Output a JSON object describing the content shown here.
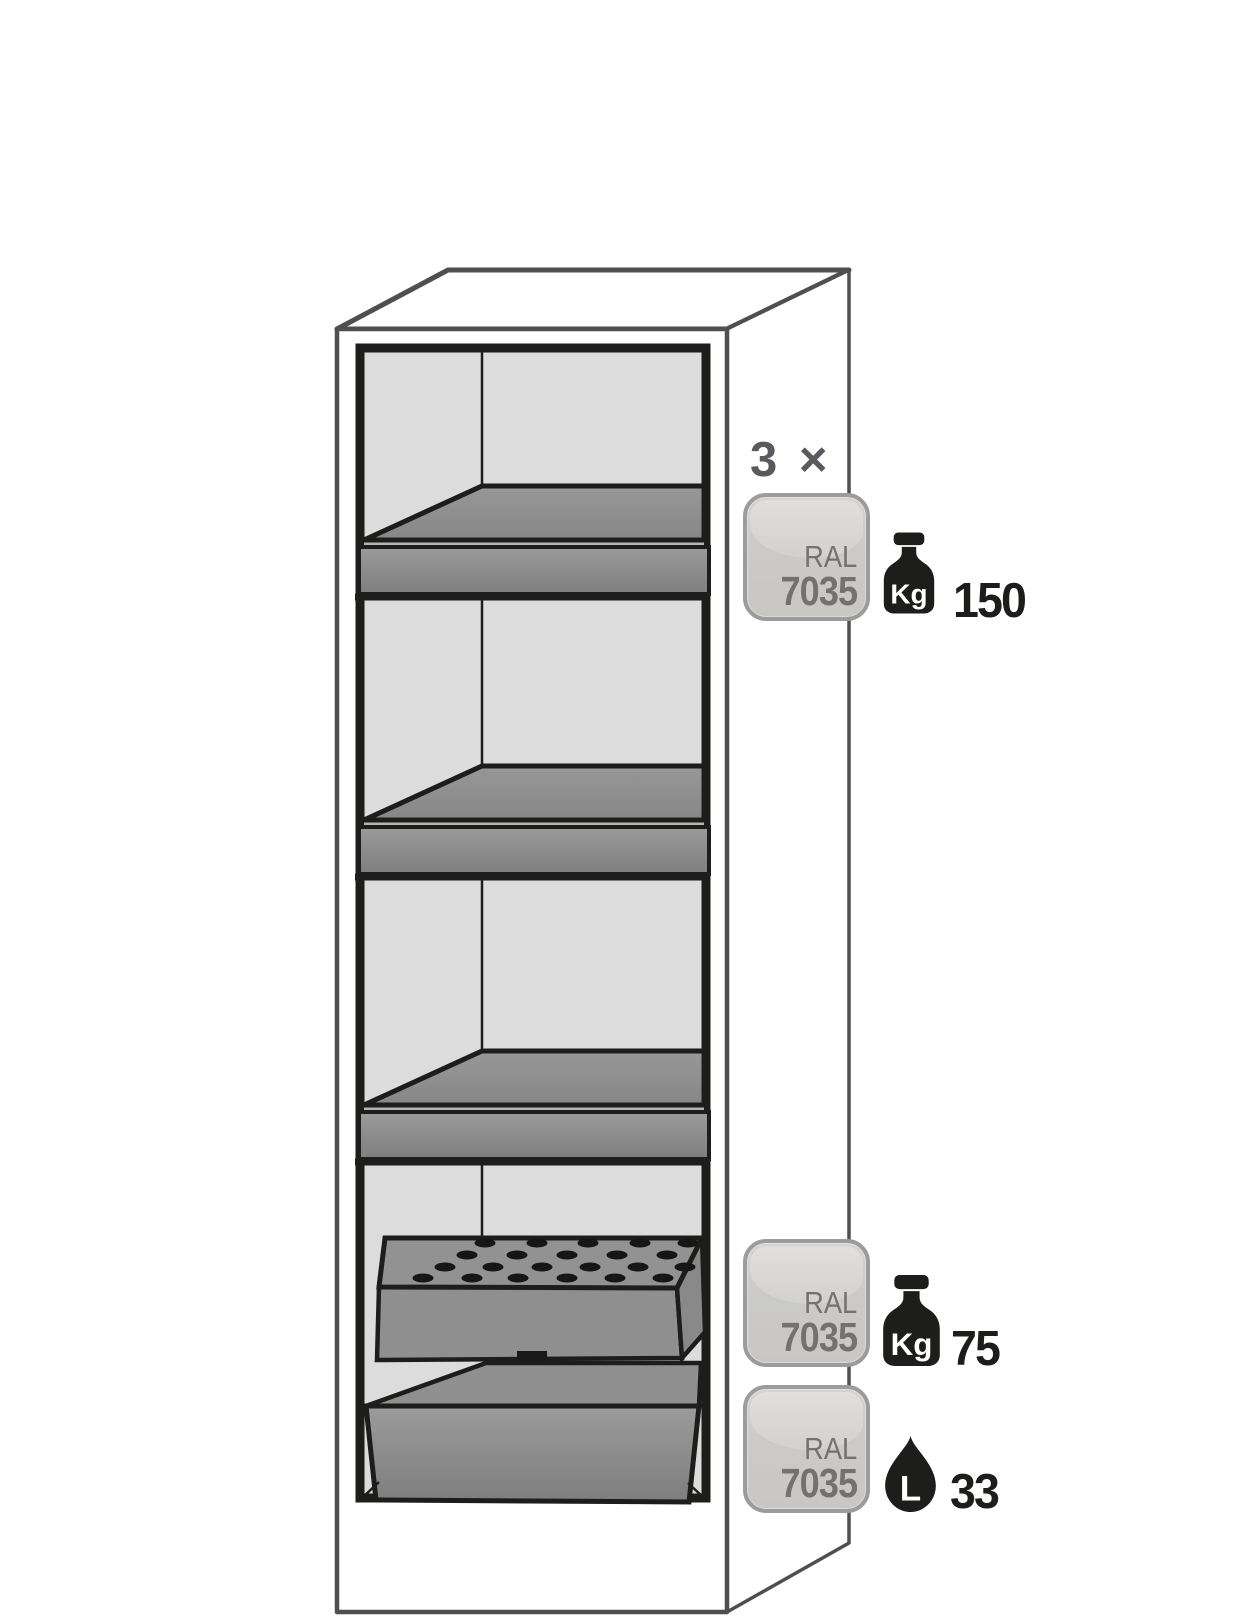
{
  "diagram": {
    "subject": "safety cabinet interior with shelves, perforated insert and sump tray",
    "colors": {
      "interior_grey": "#dcdcdc",
      "tray_grey": "#8f8f8f",
      "outline_black": "#1d1d1b",
      "cabinet_line_grey": "#4f4f4f",
      "badge_border_grey": "#9c9c9c",
      "badge_text_grey": "#74726e",
      "count_label_grey": "#5a5a5e"
    },
    "annotations": {
      "shelves": {
        "count_label": "3 ×",
        "ral_line1": "RAL",
        "ral_line2": "7035",
        "unit": "Kg",
        "value": "150"
      },
      "insert": {
        "ral_line1": "RAL",
        "ral_line2": "7035",
        "unit": "Kg",
        "value": "75"
      },
      "sump": {
        "ral_line1": "RAL",
        "ral_line2": "7035",
        "unit": "L",
        "value": "33"
      }
    }
  }
}
